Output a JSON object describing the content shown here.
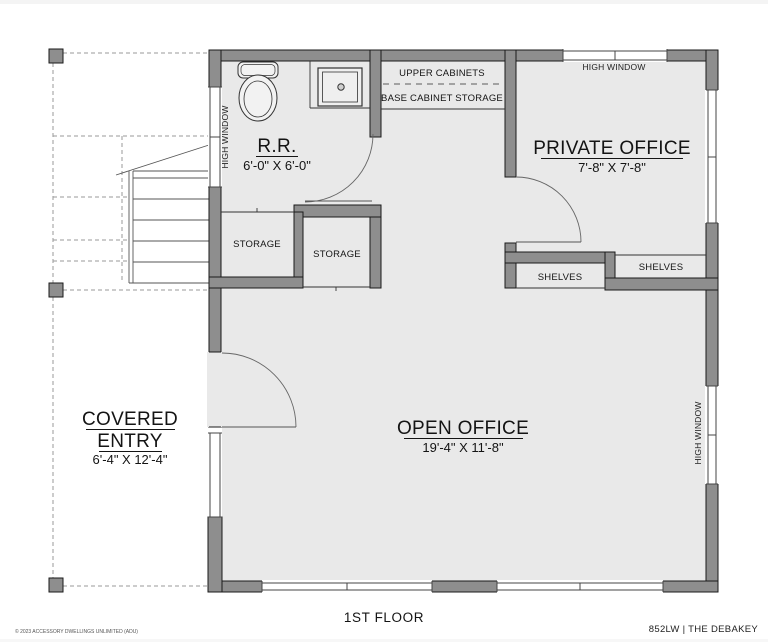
{
  "title": "1ST FLOOR",
  "plan_id": "852LW | THE DEBAKEY",
  "copyright": "© 2023 ACCESSORY DWELLINGS UNLIMITED (ADU)",
  "colors": {
    "wall": "#8e8e8e",
    "floor": "#e9e9e9",
    "outline": "#1a1a1a"
  },
  "rooms": {
    "restroom": {
      "name": "R.R.",
      "dims": "6'-0\" X 6'-0\""
    },
    "private_office": {
      "name": "PRIVATE OFFICE",
      "dims": "7'-8\" X 7'-8\""
    },
    "open_office": {
      "name": "OPEN OFFICE",
      "dims": "19'-4\" X 11'-8\""
    },
    "covered_entry": {
      "name_line1": "COVERED",
      "name_line2": "ENTRY",
      "dims": "6'-4\" X 12'-4\""
    },
    "storage_left": {
      "name": "STORAGE"
    },
    "storage_right": {
      "name": "STORAGE"
    }
  },
  "labels": {
    "upper_cabinets": "UPPER CABINETS",
    "base_cabinet_storage": "BASE CABINET STORAGE",
    "shelves_left": "SHELVES",
    "shelves_right": "SHELVES",
    "high_window_top": "HIGH WINDOW",
    "high_window_left": "HIGH WINDOW",
    "high_window_right": "HIGH WINDOW"
  }
}
